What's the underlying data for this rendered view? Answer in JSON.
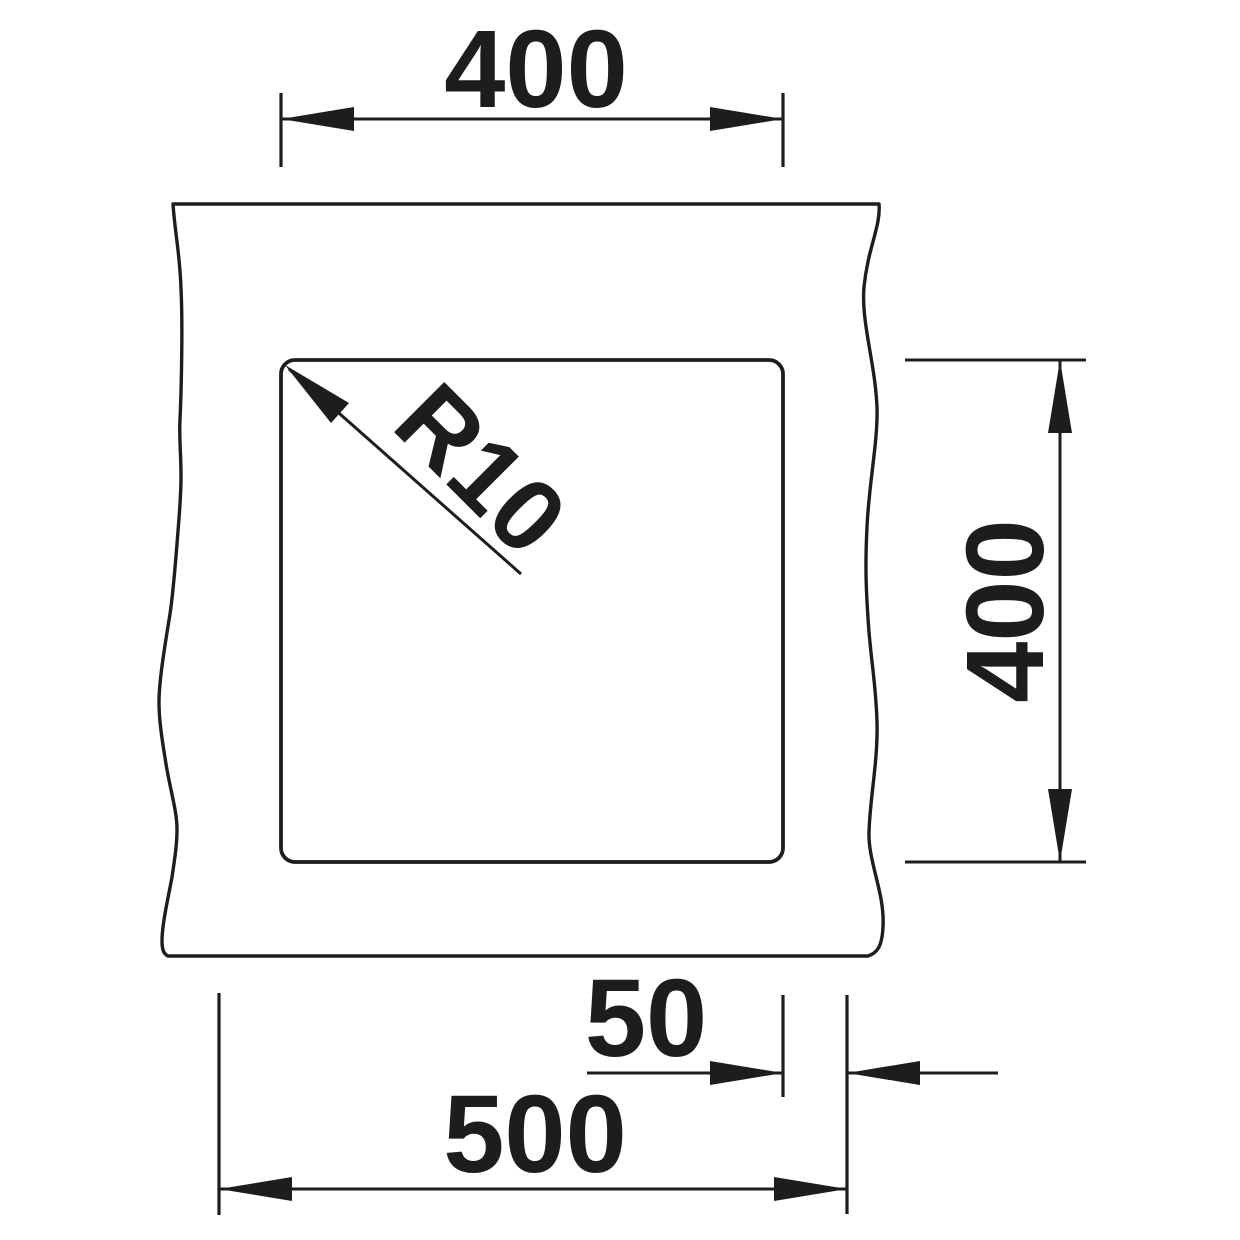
{
  "drawing": {
    "colors": {
      "ink": "#1d1d1b",
      "background": "#ffffff"
    }
  },
  "dimensions": {
    "cutout_width": "400",
    "cutout_height": "400",
    "corner_radius": "R10",
    "edge_offset": "50",
    "overall_width": "500"
  }
}
